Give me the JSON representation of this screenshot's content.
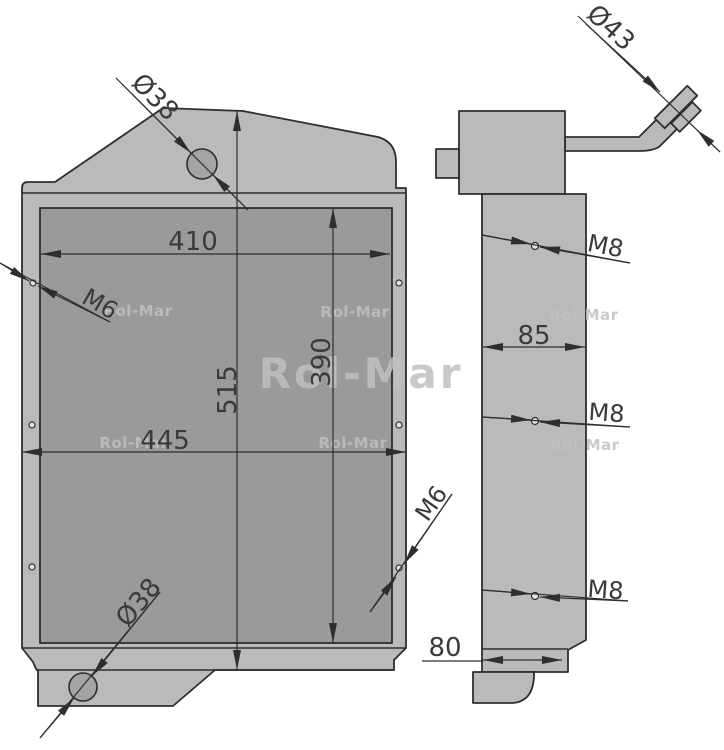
{
  "drawing_type": "radiator technical drawing, front and side views",
  "watermark": {
    "large": "Rol-Mar",
    "small": "Rol-Mar"
  },
  "front_view": {
    "dim_core_width": "410",
    "dim_core_height": "390",
    "dim_overall_height": "515",
    "dim_overall_width": "445",
    "label_top_port_diameter": "Ø38",
    "label_bottom_port_diameter": "Ø38",
    "label_thread_top_left": "M6",
    "label_thread_bottom_right": "M6"
  },
  "side_view": {
    "dim_depth": "85",
    "dim_foot_depth": "80",
    "label_inlet_pipe_diameter": "Ø43",
    "label_thread_top": "M8",
    "label_thread_middle": "M8",
    "label_thread_bottom": "M8"
  },
  "colors": {
    "background": "#ffffff",
    "shell": "#bababa",
    "core": "#9a9a9a",
    "port": "#a4a4a4",
    "line": "#2e2e2e",
    "dim_text": "#3a3a3a",
    "watermark": "#c0c0c0"
  }
}
